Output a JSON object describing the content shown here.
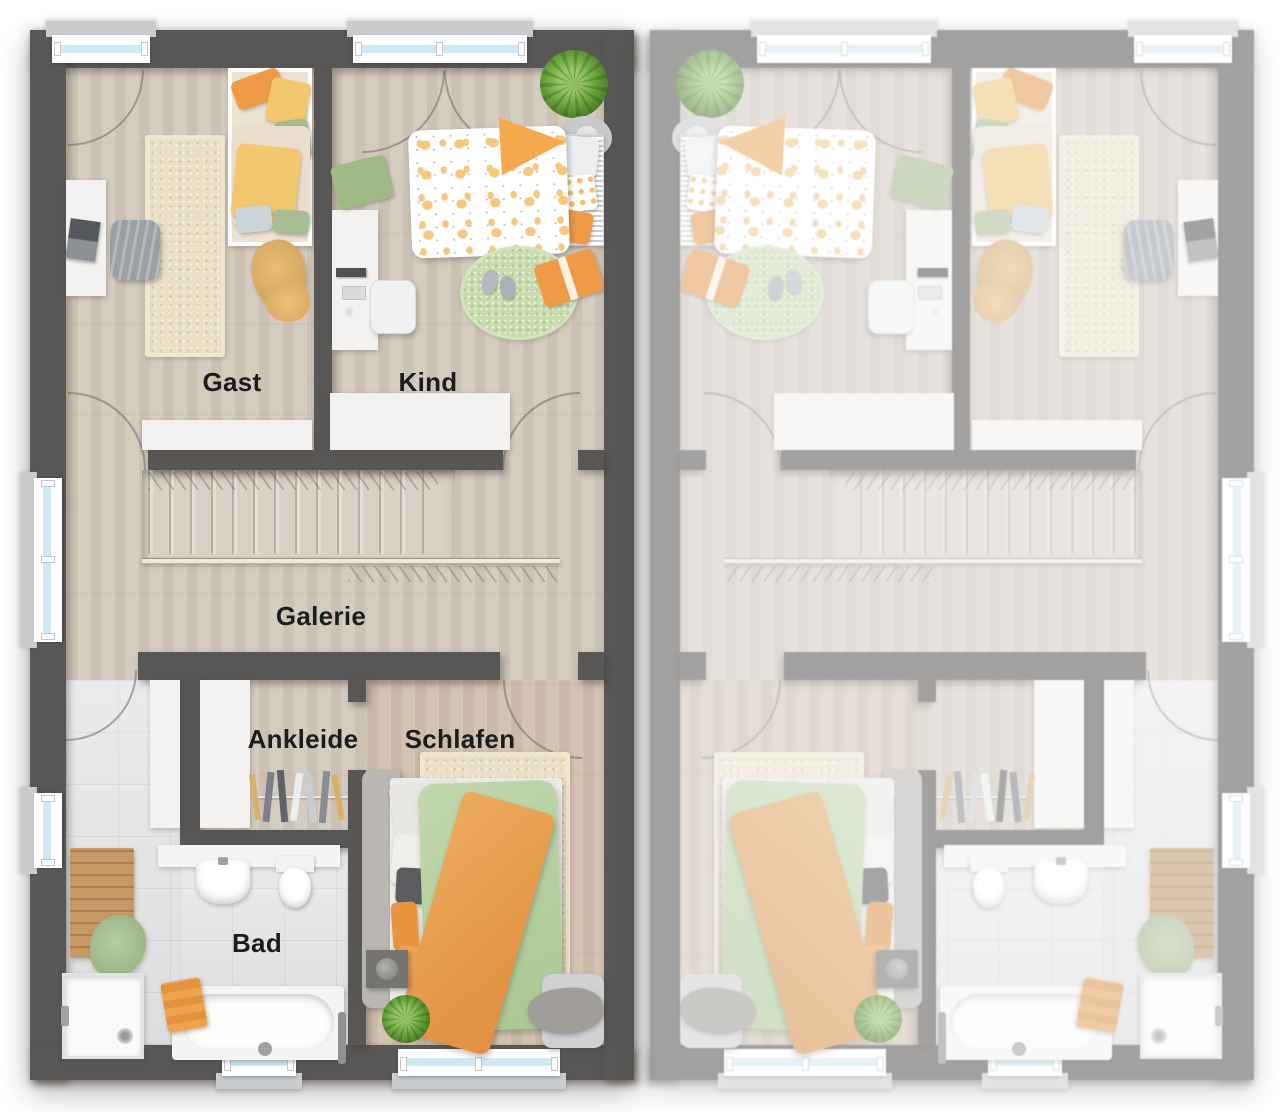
{
  "plan": {
    "type": "residential-floorplan-top-view",
    "units": {
      "left": {
        "description": "active unit with room labels"
      },
      "right": {
        "description": "mirrored neighbouring unit shown faded, no labels"
      }
    }
  },
  "rooms": {
    "gast": {
      "label": "Gast"
    },
    "kind": {
      "label": "Kind"
    },
    "galerie": {
      "label": "Galerie"
    },
    "ankleide": {
      "label": "Ankleide"
    },
    "schlafen": {
      "label": "Schlafen"
    },
    "bad": {
      "label": "Bad"
    }
  },
  "colors": {
    "wall": "#595755",
    "floor_wood": "#d5ccc0",
    "floor_wood_warm": "#d3c3b3",
    "floor_tile": "#e1e1e4",
    "window_glass": "#cfe9f7",
    "window_sill": "#c9cdd0",
    "rug_beige": "#e9dfc4",
    "rug_green": "#c8dcae",
    "accent_orange": "#ee9a47",
    "accent_yellow": "#f2c76e",
    "accent_green": "#a4bd8d",
    "duvet_green": "#b6d1a1",
    "furniture_white": "#f3f2f0",
    "furniture_gray": "#a7aaad",
    "label": "#1c1c1c"
  }
}
